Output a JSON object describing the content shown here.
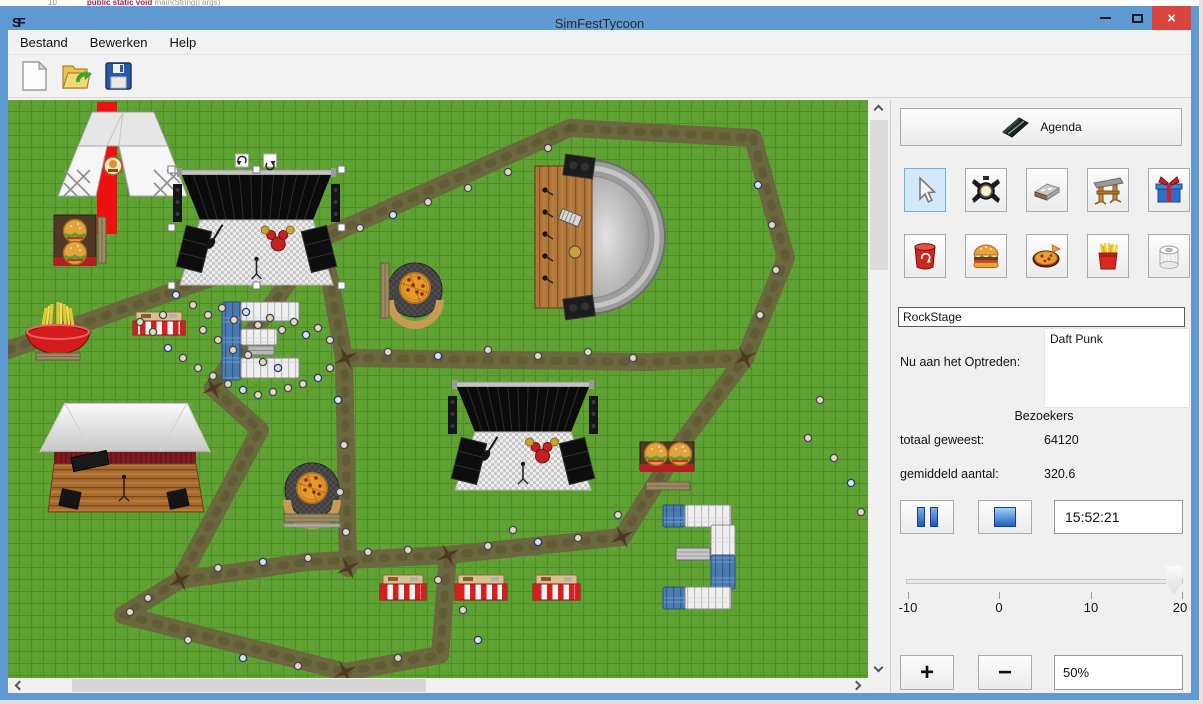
{
  "desktop": {
    "code_line": "10",
    "code_kw": "public static void",
    "code_rest": " main(String[] args)"
  },
  "window": {
    "app_initials": "SF",
    "title": "SimFestTycoon"
  },
  "menu": {
    "items": [
      "Bestand",
      "Bewerken",
      "Help"
    ]
  },
  "toolbar": {
    "buttons": [
      "new-file",
      "open-file",
      "save-file"
    ]
  },
  "panel": {
    "agenda_label": "Agenda",
    "tools_row1": [
      "select-tool",
      "spotlight-tool",
      "path-tool",
      "stage-tool",
      "gift-tool"
    ],
    "tools_row2": [
      "trash-tool",
      "burger-tool",
      "pizza-tool",
      "fries-tool",
      "toilet-tool"
    ],
    "selected_tool": "select-tool",
    "stage_name": "RockStage",
    "now_performing_label": "Nu aan het Optreden:",
    "performer": "Daft Punk",
    "visitors_header": "Bezoekers",
    "total_label": "totaal geweest:",
    "total_value": "64120",
    "avg_label": "gemiddeld aantal:",
    "avg_value": "320.6",
    "time_value": "15:52:21",
    "slider": {
      "min": -10,
      "max": 20,
      "value": 20,
      "ticks": [
        "-10",
        "0",
        "10",
        "20"
      ]
    },
    "zoom": {
      "plus": "+",
      "minus": "−",
      "value": "50%"
    }
  },
  "colors": {
    "titlebar": "#5f9ad2",
    "close": "#d9453c",
    "grass": "#5fa233",
    "path": "#6b673e",
    "selection": "#d3e8fb",
    "red_road": "#ee1010"
  },
  "map": {
    "paths": [
      [
        [
          0,
          250
        ],
        [
          310,
          140
        ]
      ],
      [
        [
          310,
          140
        ],
        [
          562,
          28
        ]
      ],
      [
        [
          562,
          28
        ],
        [
          745,
          38
        ]
      ],
      [
        [
          745,
          38
        ],
        [
          778,
          158
        ],
        [
          737,
          258
        ]
      ],
      [
        [
          737,
          258
        ],
        [
          640,
          262
        ],
        [
          340,
          258
        ]
      ],
      [
        [
          310,
          140
        ],
        [
          322,
          180
        ],
        [
          336,
          258
        ],
        [
          340,
          468
        ]
      ],
      [
        [
          205,
          288
        ],
        [
          252,
          330
        ],
        [
          172,
          480
        ]
      ],
      [
        [
          172,
          480
        ],
        [
          300,
          462
        ],
        [
          440,
          455
        ]
      ],
      [
        [
          440,
          455
        ],
        [
          614,
          437
        ]
      ],
      [
        [
          614,
          437
        ],
        [
          672,
          345
        ],
        [
          737,
          258
        ]
      ],
      [
        [
          172,
          480
        ],
        [
          115,
          515
        ]
      ],
      [
        [
          115,
          515
        ],
        [
          337,
          572
        ]
      ],
      [
        [
          337,
          572
        ],
        [
          432,
          555
        ],
        [
          440,
          455
        ]
      ],
      [
        [
          310,
          140
        ],
        [
          205,
          288
        ]
      ]
    ],
    "junctions": [
      [
        310,
        140
      ],
      [
        338,
        258
      ],
      [
        172,
        480
      ],
      [
        614,
        437
      ],
      [
        337,
        572
      ],
      [
        737,
        258
      ],
      [
        440,
        455
      ],
      [
        340,
        468
      ],
      [
        205,
        288
      ]
    ],
    "objects": [
      {
        "type": "redroad",
        "x": 89,
        "y": 2,
        "w": 20,
        "h": 132
      },
      {
        "type": "tent",
        "x": 52,
        "y": 10
      },
      {
        "type": "burger",
        "variant": "v"
      },
      {
        "type": "burger",
        "variant": "h"
      },
      {
        "type": "fries",
        "x": 17,
        "y": 205
      },
      {
        "type": "pizza",
        "cx": 407,
        "cy": 190,
        "bench": "left"
      },
      {
        "type": "pizza",
        "cx": 304,
        "cy": 390,
        "bench": "bottom"
      },
      {
        "type": "stage",
        "x": 165,
        "y": 70,
        "w": 167,
        "h": 115,
        "selected": true,
        "label": "RockStage"
      },
      {
        "type": "stage",
        "x": 440,
        "y": 282,
        "w": 150,
        "h": 108,
        "selected": false
      },
      {
        "type": "amphitheater",
        "x": 527,
        "y": 57
      },
      {
        "type": "barnstage",
        "x": 32,
        "y": 303
      },
      {
        "type": "striped",
        "x": 125,
        "y": 212,
        "w": 52,
        "h": 23
      },
      {
        "type": "striped",
        "x": 372,
        "y": 475,
        "w": 46,
        "h": 25
      },
      {
        "type": "striped",
        "x": 447,
        "y": 475,
        "w": 52,
        "h": 25
      },
      {
        "type": "striped",
        "x": 525,
        "y": 475,
        "w": 47,
        "h": 25
      },
      {
        "type": "toilets",
        "open": "right"
      },
      {
        "type": "toilets",
        "open": "left"
      }
    ],
    "people": [
      [
        168,
        195
      ],
      [
        185,
        205
      ],
      [
        200,
        215
      ],
      [
        214,
        208
      ],
      [
        226,
        220
      ],
      [
        238,
        212
      ],
      [
        250,
        225
      ],
      [
        262,
        218
      ],
      [
        274,
        230
      ],
      [
        286,
        222
      ],
      [
        298,
        235
      ],
      [
        310,
        228
      ],
      [
        322,
        240
      ],
      [
        155,
        215
      ],
      [
        145,
        232
      ],
      [
        160,
        248
      ],
      [
        175,
        258
      ],
      [
        190,
        268
      ],
      [
        205,
        276
      ],
      [
        220,
        284
      ],
      [
        235,
        290
      ],
      [
        250,
        295
      ],
      [
        265,
        292
      ],
      [
        280,
        288
      ],
      [
        295,
        284
      ],
      [
        310,
        278
      ],
      [
        322,
        268
      ],
      [
        132,
        222
      ],
      [
        240,
        255
      ],
      [
        255,
        262
      ],
      [
        270,
        268
      ],
      [
        225,
        250
      ],
      [
        210,
        240
      ],
      [
        195,
        230
      ],
      [
        352,
        128
      ],
      [
        385,
        115
      ],
      [
        420,
        102
      ],
      [
        460,
        88
      ],
      [
        500,
        72
      ],
      [
        540,
        48
      ],
      [
        750,
        85
      ],
      [
        764,
        125
      ],
      [
        768,
        170
      ],
      [
        752,
        215
      ],
      [
        380,
        252
      ],
      [
        430,
        256
      ],
      [
        480,
        250
      ],
      [
        530,
        256
      ],
      [
        580,
        252
      ],
      [
        625,
        258
      ],
      [
        330,
        300
      ],
      [
        336,
        345
      ],
      [
        332,
        392
      ],
      [
        338,
        432
      ],
      [
        210,
        468
      ],
      [
        255,
        462
      ],
      [
        300,
        458
      ],
      [
        360,
        452
      ],
      [
        400,
        450
      ],
      [
        480,
        446
      ],
      [
        530,
        442
      ],
      [
        570,
        438
      ],
      [
        140,
        498
      ],
      [
        122,
        512
      ],
      [
        180,
        540
      ],
      [
        235,
        558
      ],
      [
        290,
        566
      ],
      [
        390,
        558
      ],
      [
        430,
        480
      ],
      [
        455,
        510
      ],
      [
        470,
        540
      ],
      [
        505,
        430
      ],
      [
        610,
        415
      ],
      [
        800,
        338
      ],
      [
        826,
        358
      ],
      [
        843,
        383
      ],
      [
        853,
        412
      ],
      [
        812,
        300
      ]
    ]
  }
}
